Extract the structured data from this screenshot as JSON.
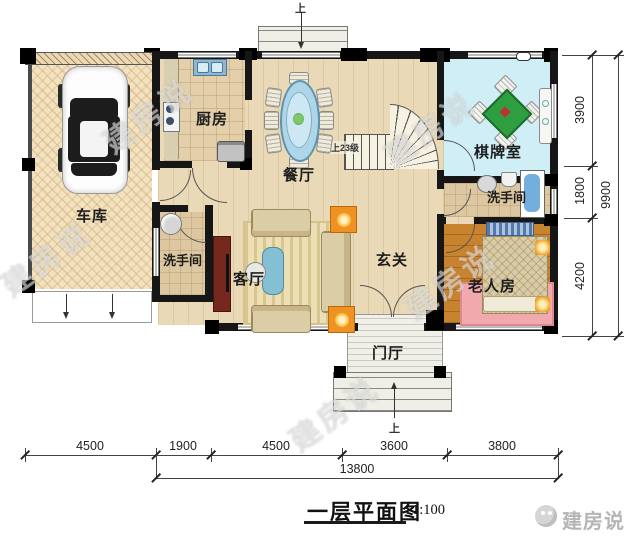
{
  "meta": {
    "title": "一层平面图",
    "scale": "1:100",
    "brand": "建房说",
    "watermark": "建房说"
  },
  "rooms": {
    "garage": "车库",
    "kitchen": "厨房",
    "dining": "餐厅",
    "chess": "棋牌室",
    "bath_right": "洗手间",
    "bath_left": "洗手间",
    "hall": "玄关",
    "living": "客厅",
    "elder": "老人房",
    "porch": "门厅"
  },
  "stairs": {
    "label": "上23级"
  },
  "arrows": {
    "up_top": "上",
    "up_bottom": "上"
  },
  "dimensions": {
    "bottom": {
      "segments": [
        "4500",
        "1900",
        "4500",
        "3600",
        "3800"
      ],
      "total": "13800"
    },
    "right": {
      "segments": [
        "3900",
        "1800",
        "4200"
      ],
      "total": "9900"
    }
  },
  "colors": {
    "wall": "#161616",
    "floor_main": "#ead9b6",
    "floor_garage": "#f3e2c0",
    "floor_chess": "#cfeef6",
    "floor_elder": "#c8832f",
    "mahjong_table": "#2f9e41",
    "dining_table": "#aed6e8",
    "accent_orange": "#ef9222",
    "bathtub": "#74aede",
    "rug_pink": "#f2a9ad"
  }
}
